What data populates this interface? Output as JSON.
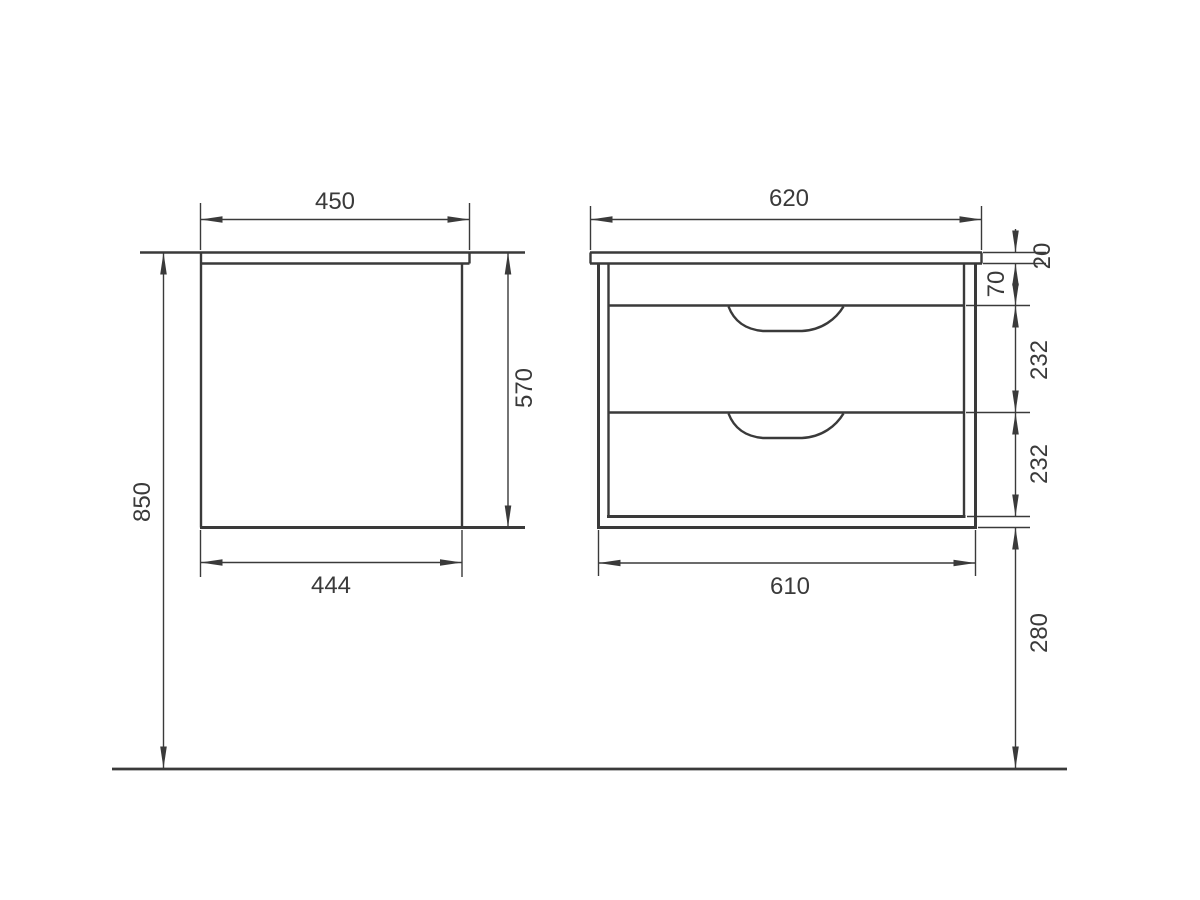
{
  "drawing": {
    "background": "#ffffff",
    "line_color": "#3a3a3a",
    "side_view": {
      "top_width": "450",
      "bottom_width": "444",
      "cabinet_height": "570",
      "total_height": "850"
    },
    "front_view": {
      "top_width": "620",
      "bottom_width": "610",
      "countertop_thickness": "20",
      "apron_height": "70",
      "upper_drawer_height": "232",
      "lower_drawer_height": "232",
      "floor_clearance": "280"
    }
  }
}
